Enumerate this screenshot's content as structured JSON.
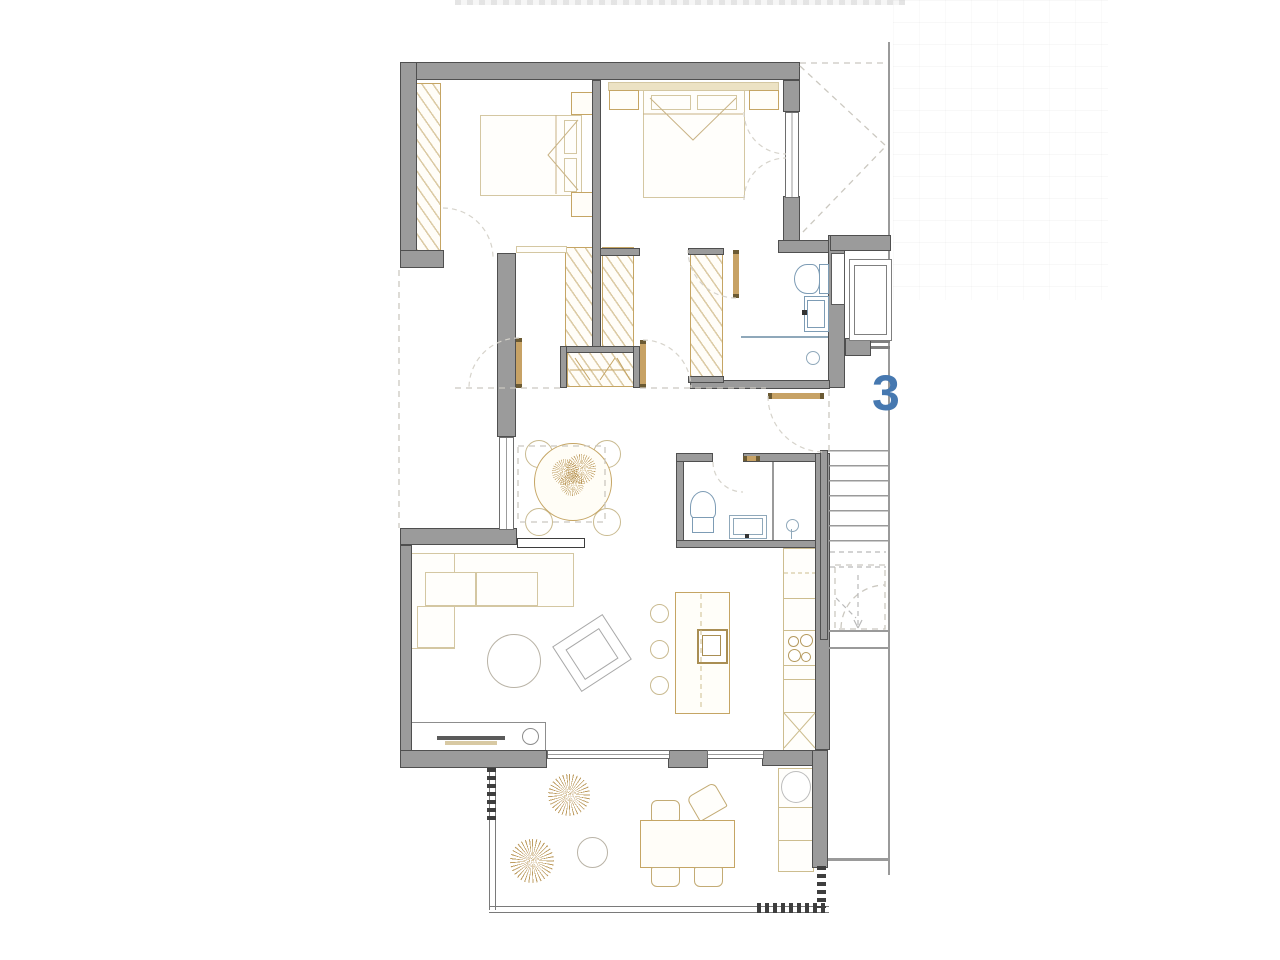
{
  "plan": {
    "unit_label": "3",
    "colors": {
      "wall_fill": "#9b9b9b",
      "wall_outline": "#4f4f4f",
      "furniture_gold": "#c5a564",
      "furniture_light": "#d4c7a2",
      "fixture_blue": "#7d9cb5",
      "unit_label_blue": "#4678b0",
      "dashed_line": "#cfccc4",
      "stair_line": "#9a9a9a",
      "background": "#ffffff"
    }
  }
}
